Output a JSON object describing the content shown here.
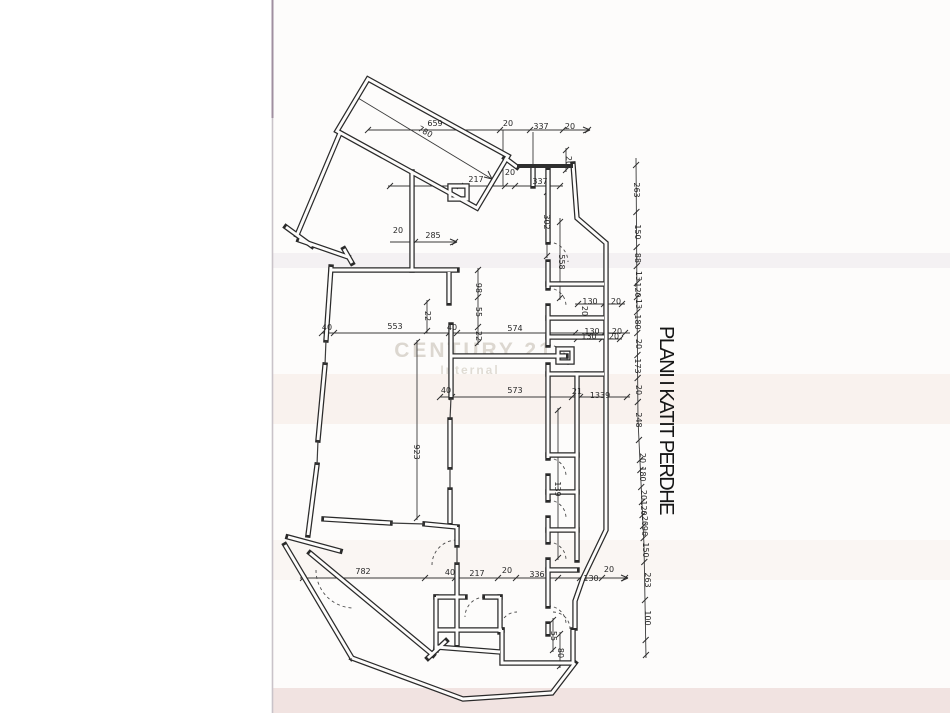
{
  "title": {
    "text": "PLANI I KATIT PERDHE"
  },
  "watermark": {
    "line1": "CENTURY 21",
    "line2": "Internal"
  },
  "colors": {
    "wall": "#2a2a2a",
    "dimension": "#3a3a3a",
    "paper": "#fdfcfb",
    "scan_edge": "#c9c3c9",
    "scan_edge_top": "#a08fa0",
    "watermark": "#c9c2b6",
    "band_warm": "#f6e9e3",
    "band_gray": "#e8e5e8",
    "band_bottom": "#eedcdb"
  },
  "dim_labels": [
    {
      "t": "659",
      "x": 435,
      "y": 126,
      "r": 0
    },
    {
      "t": "20",
      "x": 508,
      "y": 126,
      "r": 0
    },
    {
      "t": "337",
      "x": 541,
      "y": 129,
      "r": 0
    },
    {
      "t": "20",
      "x": 570,
      "y": 129,
      "r": 0
    },
    {
      "t": "780",
      "x": 424,
      "y": 134,
      "r": 29
    },
    {
      "t": "217",
      "x": 476,
      "y": 182,
      "r": 0
    },
    {
      "t": "20",
      "x": 510,
      "y": 175,
      "r": 0
    },
    {
      "t": "337",
      "x": 540,
      "y": 184,
      "r": 0
    },
    {
      "t": "302",
      "x": 544,
      "y": 222,
      "r": 90
    },
    {
      "t": "20",
      "x": 566,
      "y": 161,
      "r": 90
    },
    {
      "t": "20",
      "x": 398,
      "y": 233,
      "r": 0
    },
    {
      "t": "285",
      "x": 433,
      "y": 238,
      "r": 0
    },
    {
      "t": "40",
      "x": 327,
      "y": 330,
      "r": 0
    },
    {
      "t": "553",
      "x": 395,
      "y": 329,
      "r": 0
    },
    {
      "t": "40",
      "x": 452,
      "y": 330,
      "r": 0
    },
    {
      "t": "574",
      "x": 515,
      "y": 331,
      "r": 0
    },
    {
      "t": "130",
      "x": 592,
      "y": 334,
      "r": 0
    },
    {
      "t": "20",
      "x": 617,
      "y": 334,
      "r": 0
    },
    {
      "t": "98",
      "x": 476,
      "y": 288,
      "r": 90
    },
    {
      "t": "55",
      "x": 476,
      "y": 312,
      "r": 90
    },
    {
      "t": "22",
      "x": 476,
      "y": 336,
      "r": 90
    },
    {
      "t": "22",
      "x": 425,
      "y": 316,
      "r": 90
    },
    {
      "t": "923",
      "x": 414,
      "y": 452,
      "r": 90
    },
    {
      "t": "40",
      "x": 446,
      "y": 393,
      "r": 0
    },
    {
      "t": "573",
      "x": 515,
      "y": 393,
      "r": 0
    },
    {
      "t": "21",
      "x": 577,
      "y": 394,
      "r": 0
    },
    {
      "t": "1339",
      "x": 600,
      "y": 398,
      "r": 0
    },
    {
      "t": "139",
      "x": 555,
      "y": 489,
      "r": 90
    },
    {
      "t": "558",
      "x": 559,
      "y": 262,
      "r": 90
    },
    {
      "t": "130",
      "x": 590,
      "y": 304,
      "r": 0
    },
    {
      "t": "20",
      "x": 616,
      "y": 304,
      "r": 0
    },
    {
      "t": "20",
      "x": 582,
      "y": 311,
      "r": 90
    },
    {
      "t": "130",
      "x": 589,
      "y": 339,
      "r": 0
    },
    {
      "t": "20",
      "x": 614,
      "y": 339,
      "r": 0
    },
    {
      "t": "782",
      "x": 363,
      "y": 574,
      "r": 0
    },
    {
      "t": "40",
      "x": 450,
      "y": 575,
      "r": 0
    },
    {
      "t": "217",
      "x": 477,
      "y": 576,
      "r": 0
    },
    {
      "t": "20",
      "x": 507,
      "y": 573,
      "r": 0
    },
    {
      "t": "336",
      "x": 537,
      "y": 577,
      "r": 0
    },
    {
      "t": "130",
      "x": 591,
      "y": 581,
      "r": 0
    },
    {
      "t": "20",
      "x": 609,
      "y": 572,
      "r": 0
    },
    {
      "t": "55",
      "x": 551,
      "y": 636,
      "r": 90
    },
    {
      "t": "80",
      "x": 558,
      "y": 653,
      "r": 90
    },
    {
      "t": "263",
      "x": 634,
      "y": 190,
      "r": 90
    },
    {
      "t": "150",
      "x": 635,
      "y": 232,
      "r": 90
    },
    {
      "t": "88",
      "x": 635,
      "y": 258,
      "r": 90
    },
    {
      "t": "13",
      "x": 636,
      "y": 276,
      "r": 90
    },
    {
      "t": "120",
      "x": 635,
      "y": 290,
      "r": 90
    },
    {
      "t": "13",
      "x": 636,
      "y": 304,
      "r": 90
    },
    {
      "t": "180",
      "x": 635,
      "y": 322,
      "r": 90
    },
    {
      "t": "20",
      "x": 636,
      "y": 344,
      "r": 90
    },
    {
      "t": "173",
      "x": 635,
      "y": 366,
      "r": 90
    },
    {
      "t": "20",
      "x": 636,
      "y": 390,
      "r": 90
    },
    {
      "t": "248",
      "x": 636,
      "y": 420,
      "r": 90
    },
    {
      "t": "20",
      "x": 640,
      "y": 458,
      "r": 90
    },
    {
      "t": "180",
      "x": 640,
      "y": 474,
      "r": 90
    },
    {
      "t": "20",
      "x": 641,
      "y": 495,
      "r": 90
    },
    {
      "t": "120",
      "x": 641,
      "y": 508,
      "r": 90
    },
    {
      "t": "20",
      "x": 642,
      "y": 521,
      "r": 90
    },
    {
      "t": "96",
      "x": 642,
      "y": 531,
      "r": 90
    },
    {
      "t": "150",
      "x": 643,
      "y": 550,
      "r": 90
    },
    {
      "t": "263",
      "x": 645,
      "y": 580,
      "r": 90
    },
    {
      "t": "100",
      "x": 645,
      "y": 618,
      "r": 90
    }
  ]
}
